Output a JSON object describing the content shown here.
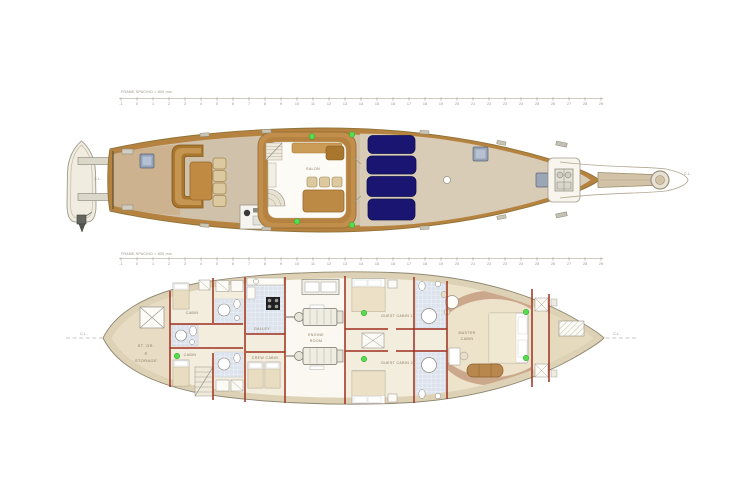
{
  "rulers": {
    "label": "FRAME SPACING = 800 mm",
    "start": -1,
    "end": 29
  },
  "upper_deck": {
    "salon": "SALON",
    "cl_stern": "C.L.",
    "cl_bow": "C.L."
  },
  "lower_deck": {
    "cl_aft": "C.L.",
    "cl_fwd": "C.L.",
    "storage_line1": "ST. GR.",
    "storage_line2": "&",
    "storage_line3": "STORAGE",
    "cabin_aft_port": "CABIN",
    "cabin_aft_stbd": "CABIN",
    "galley": "GALLEY",
    "crew_cabin": "CREW CABIN",
    "engine_line1": "ENGINE",
    "engine_line2": "ROOM",
    "guest_cabin_1": "GUEST CABIN 1",
    "guest_cabin_2": "GUEST CABIN 2",
    "master_line1": "MASTER",
    "master_line2": "CABIN"
  },
  "colors": {
    "caprail": "#b5823f",
    "deck": "#d0c1aa",
    "foredeck": "#d8ccb6",
    "sun_pad_navy": "#1a1570",
    "vent_green": "#55dd4d",
    "bulkhead_red": "#9e2f1e",
    "hull_band": "#ded2b6",
    "interior_cream": "#f3edde",
    "room_tan": "#e8ddc4",
    "tile_blue": "#dde3ec"
  }
}
